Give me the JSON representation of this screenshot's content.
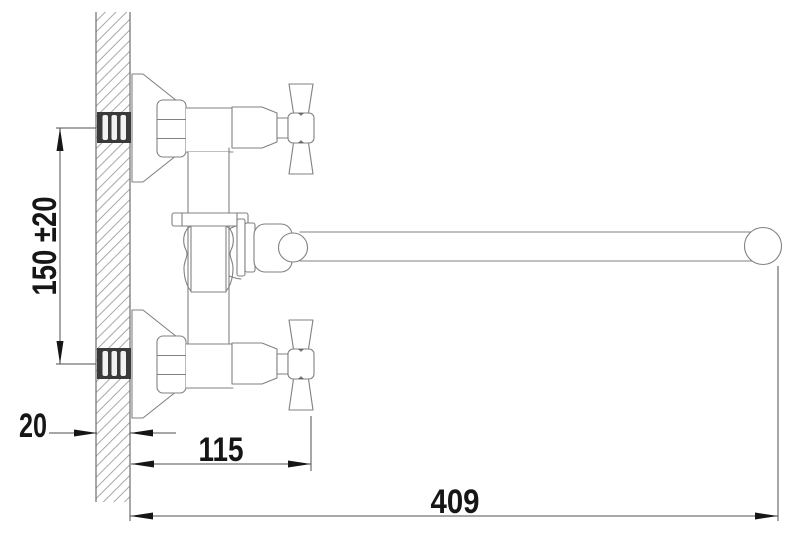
{
  "drawing": {
    "kind": "faucet-installation-dimension-drawing",
    "colors": {
      "background": "#ffffff",
      "outline": "#818181",
      "wall_edge": "#6f6f6f",
      "dimension_line": "#4f4f4f",
      "ink": "#161616",
      "hatch": "#a8a8a8",
      "fitting_dark": "#3a3a3a"
    },
    "dimension_labels": {
      "mounting_centers_vertical": "150 ±20",
      "wall_thickness": "20",
      "wall_to_handle_depth": "115",
      "spout_reach": "409"
    }
  }
}
